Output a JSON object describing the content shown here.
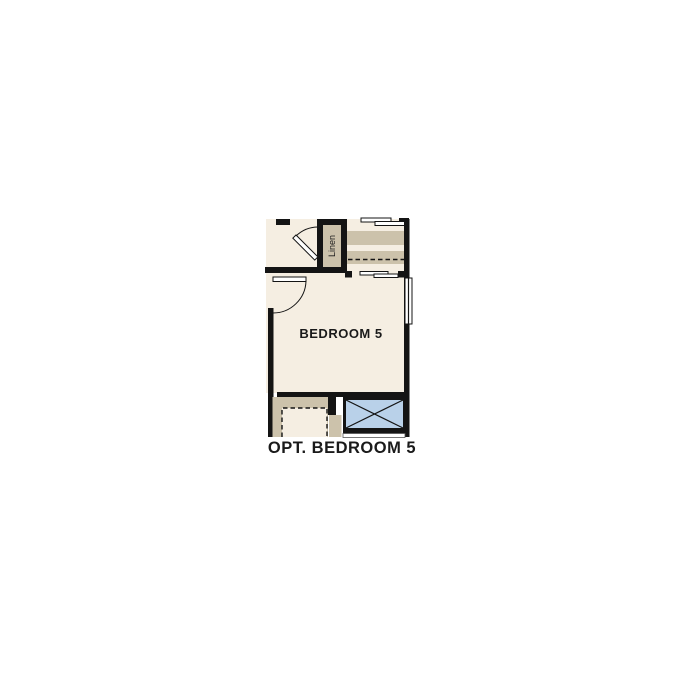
{
  "title": "Optional Bedroom 5 floor plan",
  "plan": {
    "bedroom_label": "BEDROOM 5",
    "linen_label": "Linen",
    "caption": "OPT. BEDROOM 5"
  },
  "icons": {
    "shower_symbol": "crossed-box-icon",
    "door_symbol": "door-swing-arc"
  },
  "colors": {
    "background": "#ffffff",
    "floor": "#f5eee2",
    "cabinet_tan": "#ccc2ab",
    "wall": "#141414",
    "shower_blue": "#b9d1e9",
    "text": "#1a1a1a"
  }
}
